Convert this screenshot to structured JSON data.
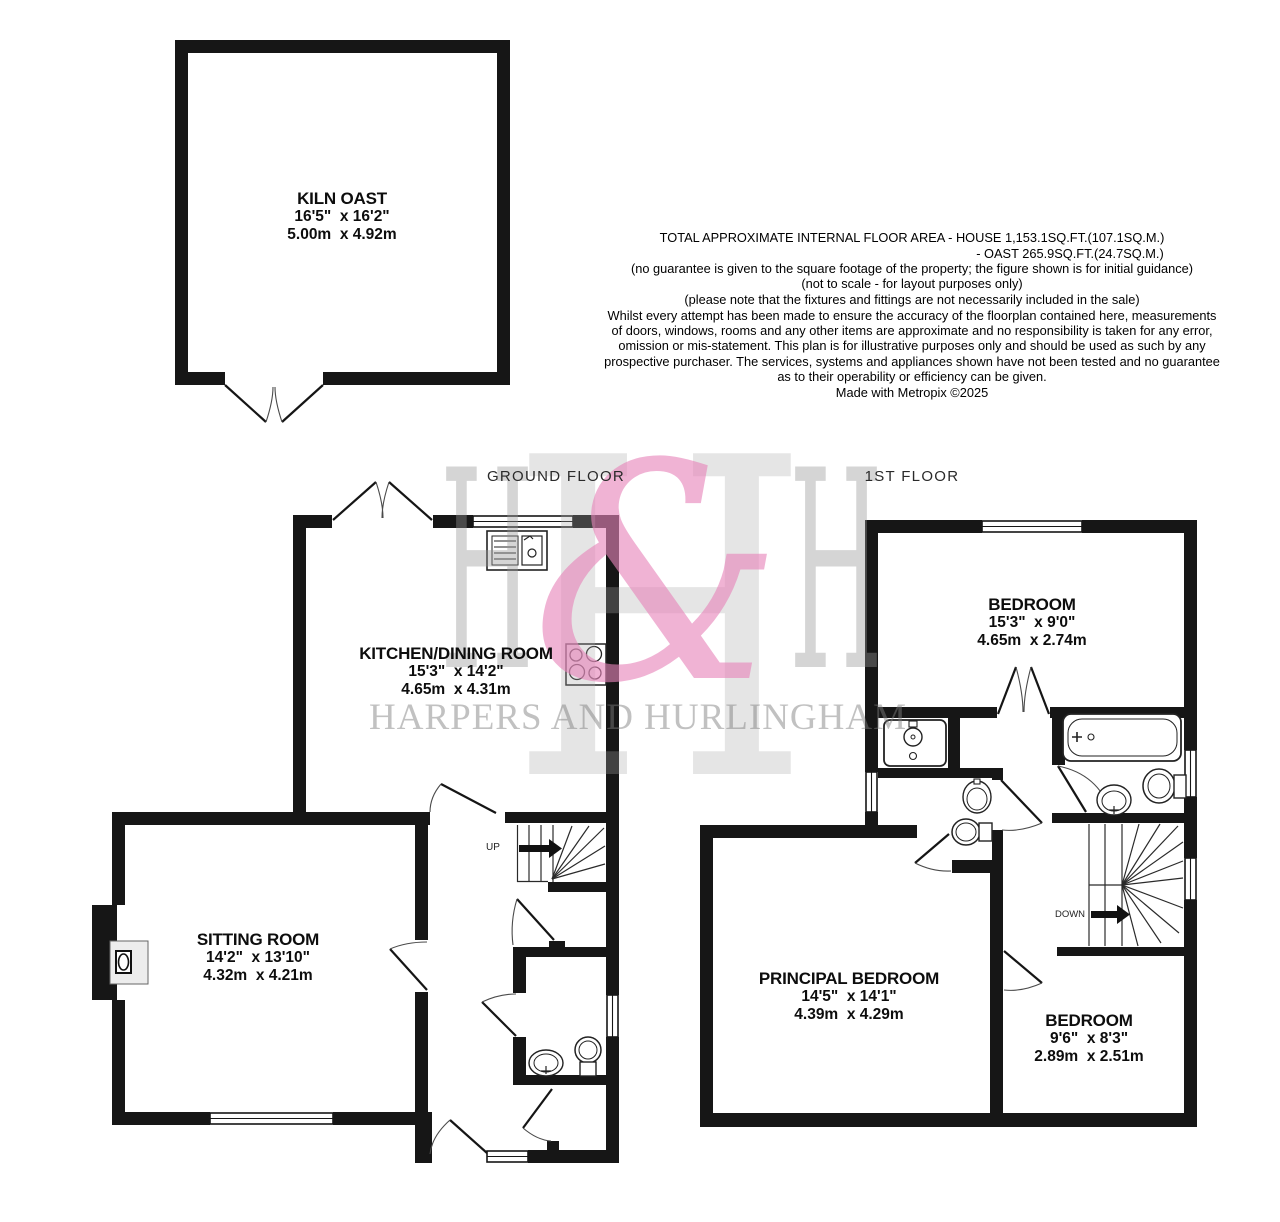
{
  "document_type": "estate-agent floorplan",
  "floor_labels": {
    "ground": "GROUND FLOOR",
    "first": "1ST FLOOR"
  },
  "rooms": {
    "kiln": {
      "name": "KILN OAST",
      "imperial": "16'5\"  x 16'2\"",
      "metric": "5.00m  x 4.92m"
    },
    "kitchen": {
      "name": "KITCHEN/DINING ROOM",
      "imperial": "15'3\"  x 14'2\"",
      "metric": "4.65m  x 4.31m"
    },
    "sitting": {
      "name": "SITTING ROOM",
      "imperial": "14'2\"  x 13'10\"",
      "metric": "4.32m  x 4.21m"
    },
    "bedroom1": {
      "name": "BEDROOM",
      "imperial": "15'3\"  x 9'0\"",
      "metric": "4.65m  x 2.74m"
    },
    "principal": {
      "name": "PRINCIPAL BEDROOM",
      "imperial": "14'5\"  x 14'1\"",
      "metric": "4.39m  x 4.29m"
    },
    "bedroom2": {
      "name": "BEDROOM",
      "imperial": "9'6\"  x 8'3\"",
      "metric": "2.89m  x 2.51m"
    }
  },
  "stairs": {
    "up": "UP",
    "down": "DOWN"
  },
  "notes": {
    "area_house": "TOTAL APPROXIMATE INTERNAL FLOOR AREA - HOUSE 1,153.1SQ.FT.(107.1SQ.M.)",
    "area_oast": "- OAST 265.9SQ.FT.(24.7SQ.M.)",
    "guarantee": "(no guarantee is given to the square footage of the property; the figure shown is for initial guidance)\n(not to scale - for layout purposes only)\n(please note that the fixtures and fittings are not necessarily included in the sale)",
    "legal": "Whilst every attempt has been made to ensure the accuracy of the floorplan contained here, measurements\nof doors, windows, rooms and any other items are approximate and no responsibility is taken for any error,\nomission or mis-statement. This plan is for illustrative purposes only and should be used as such by any\nprospective purchaser. The services, systems and appliances shown have not been tested and no guarantee\nas to their operability or efficiency can be given.",
    "credit": "Made with Metropix ©2025"
  },
  "watermark": {
    "letter": "H",
    "ampersand": "&",
    "name": "HARPERS AND HURLINGHAM"
  },
  "colors": {
    "wall": "#161616",
    "watermark_pink": "#f0b3d4",
    "watermark_gray": "#e7e7e7"
  }
}
